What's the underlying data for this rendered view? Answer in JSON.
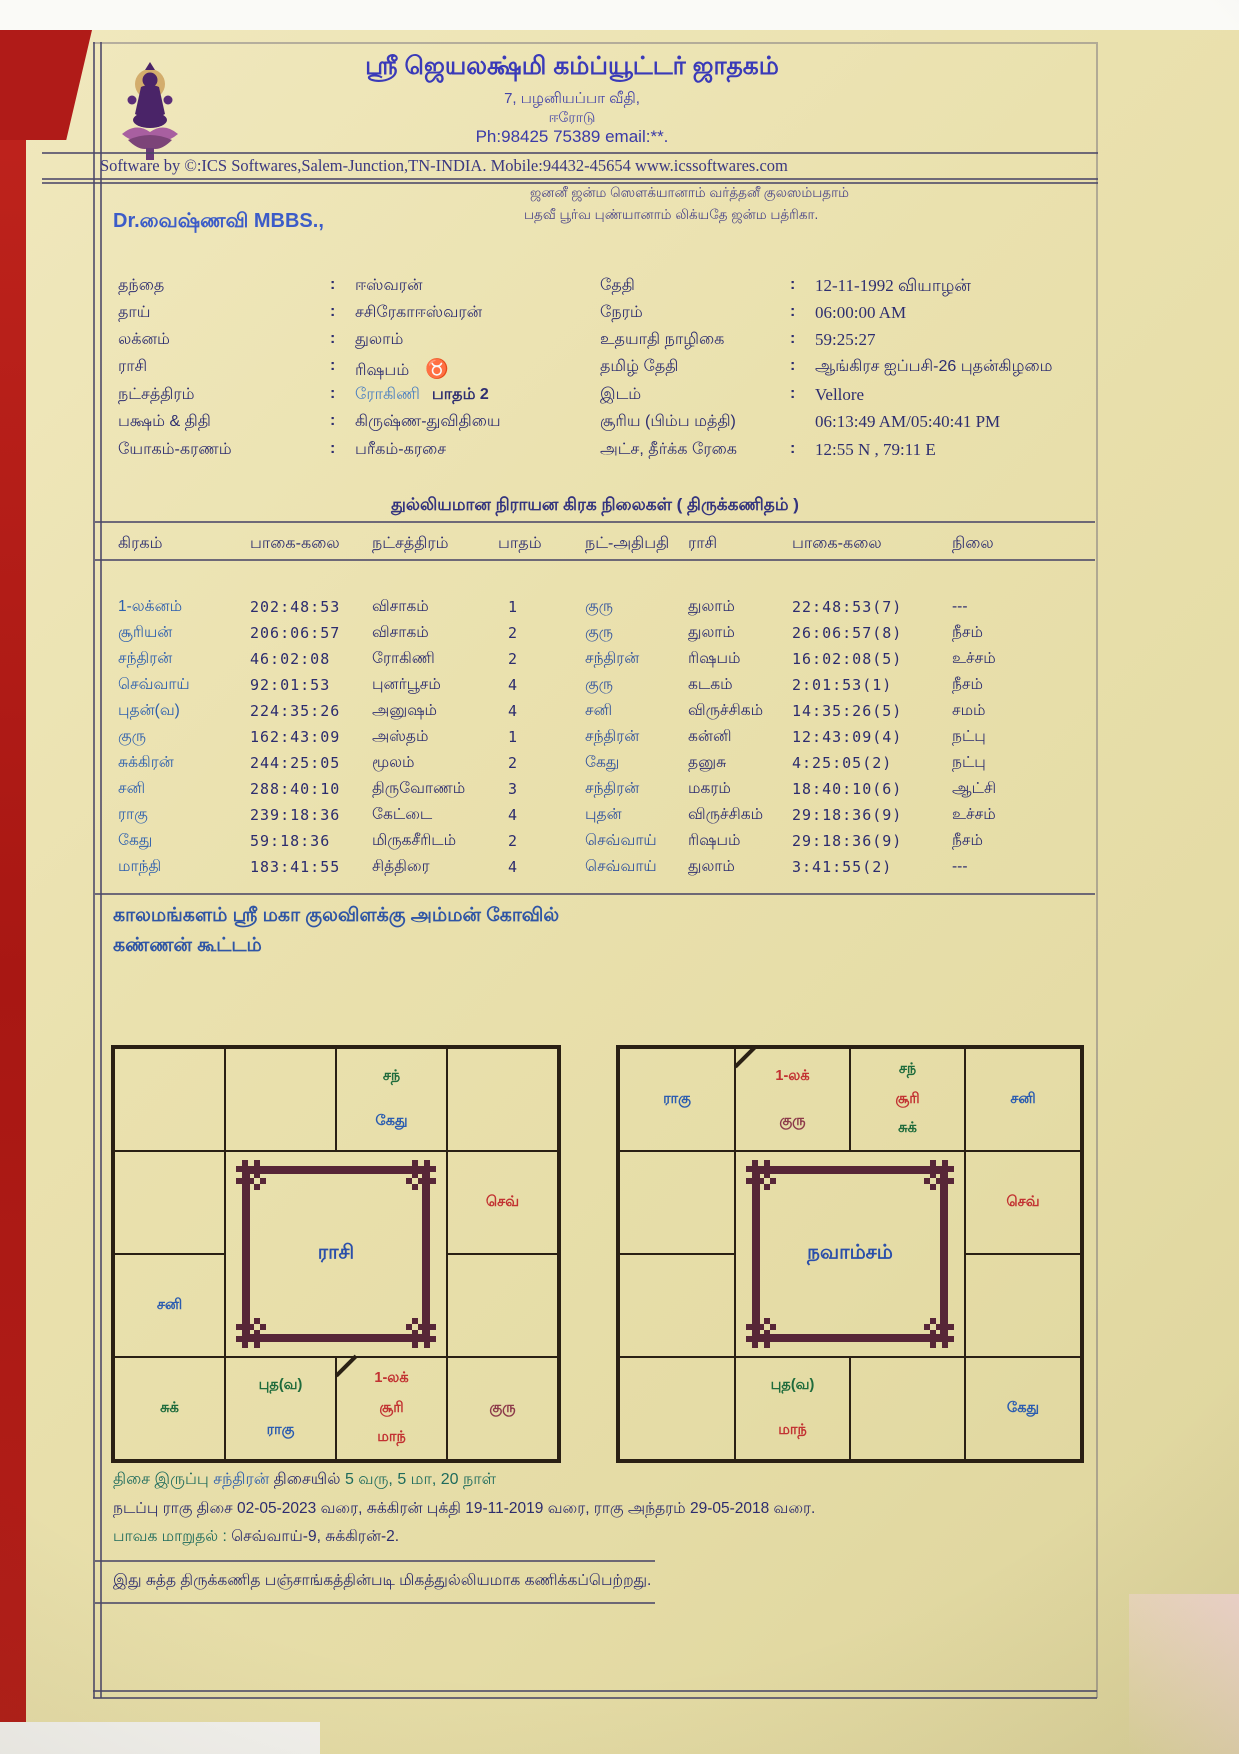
{
  "palette": {
    "paper": "#eae1ae",
    "backdrop_red": "#b01b18",
    "ink_navy": "#2e2e70",
    "planet_blue": "#2d5fae",
    "green": "#1e6b3c",
    "red": "#c23232",
    "maroon": "#8c3a4a",
    "title_blue": "#3a3ab8",
    "name_blue": "#3c5cc8",
    "chart_line": "#2a2014",
    "ornament_maroon": "#572637",
    "teal": "#1e6b5c"
  },
  "glyphs": {
    "colon": ":"
  },
  "header": {
    "logo": "lakshmi-deity-on-lotus",
    "title": "ஸ்ரீ ஜெயலக்ஷ்மி கம்ப்யூட்டர் ஜாதகம்",
    "address_line1": "7, பழனியப்பா வீதி,",
    "address_line2": "ஈரோடு",
    "phone_line": "Ph:98425 75389 email:**.",
    "software_line": "Software by ©:ICS Softwares,Salem-Junction,TN-INDIA. Mobile:94432-45654 www.icssoftwares.com"
  },
  "sloka": {
    "line1": "ஜனனீ ஜன்ம ஸௌக்யானாம் வர்த்தனீ குலஸம்பதாம்",
    "line2": "பதவீ பூர்வ புண்யானாம் லிக்யதே ஜன்ம பத்ரிகா."
  },
  "person": {
    "name": "Dr.வைஷ்ணவி MBBS.,"
  },
  "details_left": {
    "rows": [
      {
        "label": "தந்தை",
        "value": "ஈஸ்வரன்"
      },
      {
        "label": "தாய்",
        "value": "சசிரேகாஈஸ்வரன்"
      },
      {
        "label": "லக்னம்",
        "value": "துலாம்"
      },
      {
        "label": "ராசி",
        "value": "ரிஷபம்",
        "symbol": "♉"
      },
      {
        "label": "நட்சத்திரம்",
        "value": "ரோகிணி",
        "suffix": "பாதம் 2"
      },
      {
        "label": "பக்ஷம் & திதி",
        "value": "கிருஷ்ண-துவிதியை"
      },
      {
        "label": "யோகம்-கரணம்",
        "value": "பரீகம்-கரசை"
      }
    ]
  },
  "details_right": {
    "rows": [
      {
        "label": "தேதி",
        "value": "12-11-1992 வியாழன்"
      },
      {
        "label": "நேரம்",
        "value": "06:00:00 AM"
      },
      {
        "label": "உதயாதி நாழிகை",
        "value": "59:25:27"
      },
      {
        "label": "தமிழ் தேதி",
        "value": "ஆங்கிரச ஐப்பசி-26 புதன்கிழமை"
      },
      {
        "label": "இடம்",
        "value": "Vellore"
      },
      {
        "label": "சூரிய (பிம்ப மத்தி)",
        "value": "06:13:49 AM/05:40:41 PM"
      },
      {
        "label": "அட்ச, தீர்க்க ரேகை",
        "value": "12:55 N , 79:11 E"
      }
    ]
  },
  "planet_table": {
    "title": "துல்லியமான நிராயன கிரக நிலைகள் ( திருக்கணிதம் )",
    "headers": [
      "கிரகம்",
      "பாகை-கலை",
      "நட்சத்திரம்",
      "பாதம்",
      "நட்-அதிபதி",
      "ராசி",
      "பாகை-கலை",
      "நிலை"
    ],
    "rows": [
      [
        "1-லக்னம்",
        "202:48:53",
        "விசாகம்",
        "1",
        "குரு",
        "துலாம்",
        "22:48:53(7)",
        "---"
      ],
      [
        "சூரியன்",
        "206:06:57",
        "விசாகம்",
        "2",
        "குரு",
        "துலாம்",
        "26:06:57(8)",
        "நீசம்"
      ],
      [
        "சந்திரன்",
        "46:02:08",
        "ரோகிணி",
        "2",
        "சந்திரன்",
        "ரிஷபம்",
        "16:02:08(5)",
        "உச்சம்"
      ],
      [
        "செவ்வாய்",
        "92:01:53",
        "புனர்பூசம்",
        "4",
        "குரு",
        "கடகம்",
        "2:01:53(1)",
        "நீசம்"
      ],
      [
        "புதன்(வ)",
        "224:35:26",
        "அனுஷம்",
        "4",
        "சனி",
        "விருச்சிகம்",
        "14:35:26(5)",
        "சமம்"
      ],
      [
        "குரு",
        "162:43:09",
        "அஸ்தம்",
        "1",
        "சந்திரன்",
        "கன்னி",
        "12:43:09(4)",
        "நட்பு"
      ],
      [
        "சுக்கிரன்",
        "244:25:05",
        "மூலம்",
        "2",
        "கேது",
        "தனுசு",
        "4:25:05(2)",
        "நட்பு"
      ],
      [
        "சனி",
        "288:40:10",
        "திருவோணம்",
        "3",
        "சந்திரன்",
        "மகரம்",
        "18:40:10(6)",
        "ஆட்சி"
      ],
      [
        "ராகு",
        "239:18:36",
        "கேட்டை",
        "4",
        "புதன்",
        "விருச்சிகம்",
        "29:18:36(9)",
        "உச்சம்"
      ],
      [
        "கேது",
        "59:18:36",
        "மிருகசீரிடம்",
        "2",
        "செவ்வாய்",
        "ரிஷபம்",
        "29:18:36(9)",
        "நீசம்"
      ],
      [
        "மாந்தி",
        "183:41:55",
        "சித்திரை",
        "4",
        "செவ்வாய்",
        "துலாம்",
        "3:41:55(2)",
        "---"
      ]
    ]
  },
  "notes": {
    "line1": "காலமங்களம் ஸ்ரீ மகா குலவிளக்கு அம்மன் கோவில்",
    "line2": "கண்ணன் கூட்டம்"
  },
  "rasi_chart": {
    "title": "ராசி",
    "lagna_cell": "r4c3",
    "cells": {
      "r1c3": [
        {
          "t": "சந்",
          "c": "green"
        },
        {
          "t": "கேது",
          "c": "blue"
        }
      ],
      "r2c4": [
        {
          "t": "செவ்",
          "c": "red"
        }
      ],
      "r3c1": [
        {
          "t": "சனி",
          "c": "blue"
        }
      ],
      "r4c1": [
        {
          "t": "சுக்",
          "c": "green"
        }
      ],
      "r4c2": [
        {
          "t": "புத(வ)",
          "c": "green"
        },
        {
          "t": "ராகு",
          "c": "blue"
        }
      ],
      "r4c3": [
        {
          "t": "1-லக்",
          "c": "red"
        },
        {
          "t": "சூரி",
          "c": "red"
        },
        {
          "t": "மாந்",
          "c": "red"
        }
      ],
      "r4c4": [
        {
          "t": "குரு",
          "c": "maroon"
        }
      ]
    }
  },
  "navamsa_chart": {
    "title": "நவாம்சம்",
    "lagna_cell": "r1c2",
    "cells": {
      "r1c1": [
        {
          "t": "ராகு",
          "c": "blue"
        }
      ],
      "r1c2": [
        {
          "t": "1-லக்",
          "c": "red"
        },
        {
          "t": "குரு",
          "c": "maroon"
        }
      ],
      "r1c3": [
        {
          "t": "சந்",
          "c": "green"
        },
        {
          "t": "சூரி",
          "c": "red"
        },
        {
          "t": "சுக்",
          "c": "green"
        }
      ],
      "r1c4": [
        {
          "t": "சனி",
          "c": "blue"
        }
      ],
      "r2c4": [
        {
          "t": "செவ்",
          "c": "red"
        }
      ],
      "r4c2": [
        {
          "t": "புத(வ)",
          "c": "green"
        },
        {
          "t": "மாந்",
          "c": "red"
        }
      ],
      "r4c4": [
        {
          "t": "கேது",
          "c": "blue"
        }
      ]
    }
  },
  "dasa": {
    "line1_parts": [
      {
        "t": "திசை இருப்பு ",
        "c": "teal"
      },
      {
        "t": "சந்திரன் ",
        "c": "blue"
      },
      {
        "t": "திசையில் ",
        "c": "navy"
      },
      {
        "t": "5 வரு, 5 மா, 20 நாள்",
        "c": "teal"
      }
    ],
    "line2": "நடப்பு ராகு திசை 02-05-2023 வரை, சுக்கிரன் புக்தி 19-11-2019 வரை, ராகு அந்தரம் 29-05-2018 வரை.",
    "line3_parts": [
      {
        "t": "பாவக மாறுதல் : ",
        "c": "teal"
      },
      {
        "t": "செவ்வாய்-9, சுக்கிரன்-2.",
        "c": "navy"
      }
    ],
    "line4": "இது சுத்த திருக்கணித பஞ்சாங்கத்தின்படி மிகத்துல்லியமாக கணிக்கப்பெற்றது."
  }
}
